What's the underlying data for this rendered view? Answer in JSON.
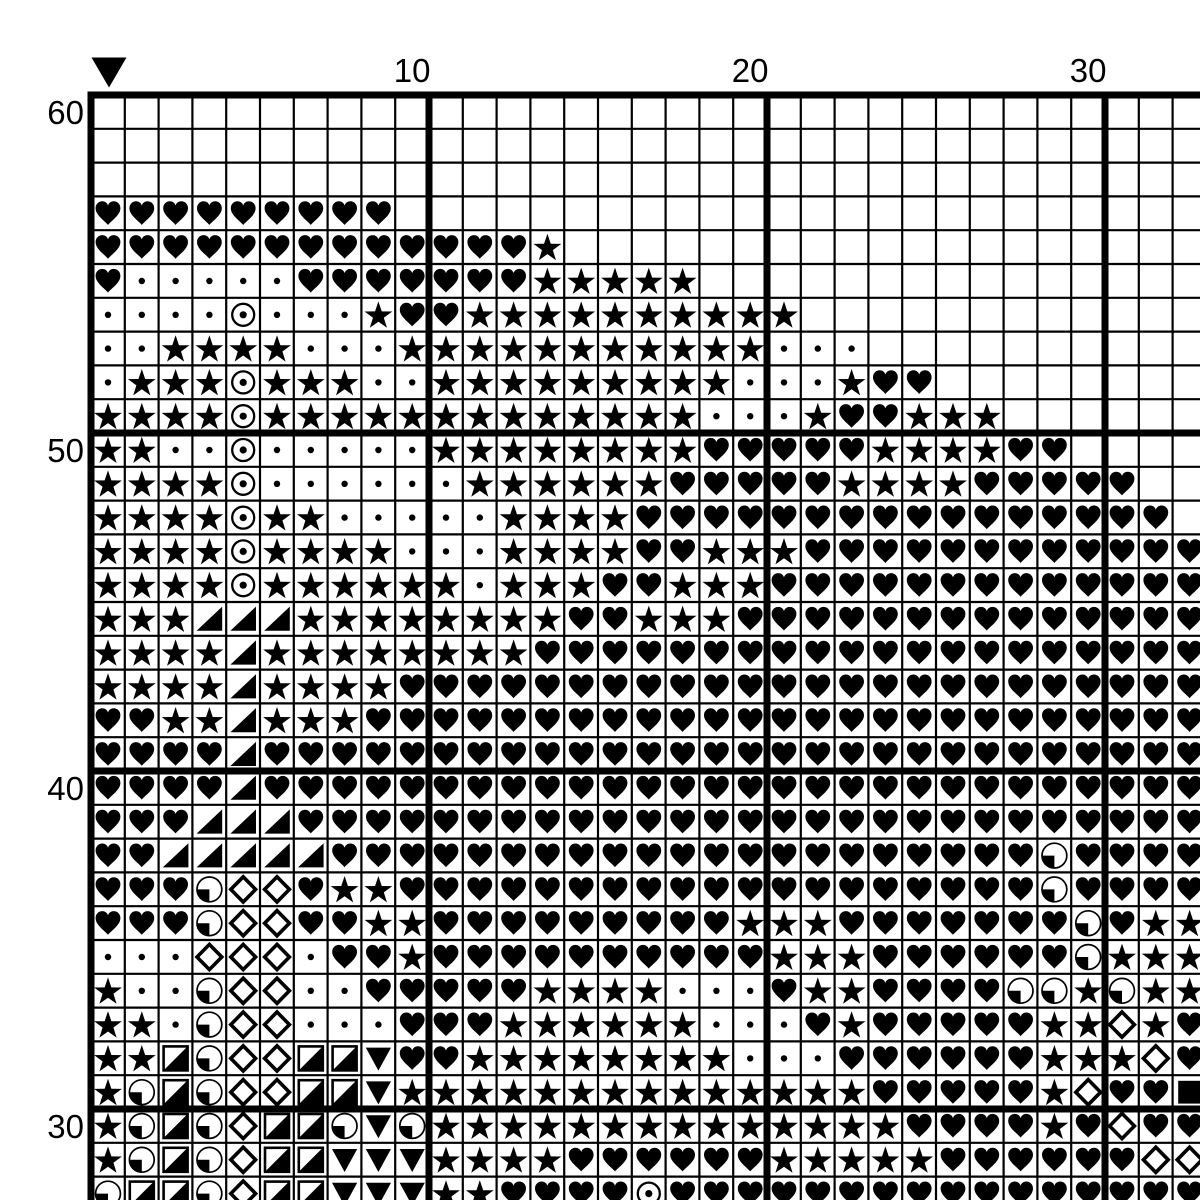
{
  "title": "Cross-stitch pattern chart",
  "colors": {
    "ink": "#000000",
    "background": "#ffffff"
  },
  "legend": {
    "H": "heart",
    "S": "star",
    "d": "dot",
    "O": "circled-dot",
    "T": "shaded-triangle",
    "D": "diamond",
    "Q": "quarter-circle",
    "R": "half-square",
    "V": "down-triangle",
    "B": "solid-square",
    ".": "empty"
  },
  "chart_data": {
    "type": "heatmap",
    "title": "Cross-stitch symbol grid",
    "grid_on": true,
    "cell_rule_every": 10,
    "x_axis": {
      "labels": [
        "10",
        "20",
        "30"
      ],
      "positions": [
        10,
        20,
        30
      ]
    },
    "y_axis": {
      "labels": [
        "60",
        "50",
        "40",
        "30"
      ],
      "positions": [
        60,
        50,
        40,
        30
      ]
    },
    "center_marker": {
      "symbol": "down-triangle",
      "col": 1
    },
    "first_col": 1,
    "first_row": 60,
    "cols_visible": 33,
    "rows": [
      {
        "row": 60,
        "cells": "................................."
      },
      {
        "row": 59,
        "cells": "................................."
      },
      {
        "row": 58,
        "cells": "................................."
      },
      {
        "row": 57,
        "cells": "HHHHHHHHH........................"
      },
      {
        "row": 56,
        "cells": "HHHHHHHHHHHHHS..................."
      },
      {
        "row": 55,
        "cells": "HdddddHHHHHHHSSSSS..............."
      },
      {
        "row": 54,
        "cells": "ddddOdddSHHSSSSSSSSSS............"
      },
      {
        "row": 53,
        "cells": "ddSSSSdddSSSSSSSSSSSddd.........."
      },
      {
        "row": 52,
        "cells": "dSSSOSSSddSSSSSSSSSdddSHH........"
      },
      {
        "row": 51,
        "cells": "SSSSOSSSSSSSSSSSSSdddSHHSSS......"
      },
      {
        "row": 50,
        "cells": "SSddOdddddSSSSSSSSHHHHHSSSSHH...."
      },
      {
        "row": 49,
        "cells": "SSSSOddddddSSSSSSHHHHHSSSSHHHHH.."
      },
      {
        "row": 48,
        "cells": "SSSSOSSdddddSSSSHHHHHHHHHHHHHHHH."
      },
      {
        "row": 47,
        "cells": "SSSSOSSSSdddSSSSHHSSSHHHHHHHHHHHH"
      },
      {
        "row": 46,
        "cells": "SSSSOSSSSSSdSSSHHSSSHHHHHHHHHHHHH"
      },
      {
        "row": 45,
        "cells": "SSSTTTSSSSSSSSHHSSSHHHHHHHHHHHHHH"
      },
      {
        "row": 44,
        "cells": "SSSSTSSSSSSSSHHHHHHHHHHHHHHHHHHHH"
      },
      {
        "row": 43,
        "cells": "SSSSTSSSSHHHHHHHHHHHHHHHHHHHHHHHH"
      },
      {
        "row": 42,
        "cells": "HHSSTSSSHHHHHHHHHHHHHHHHHHHHHHHHH"
      },
      {
        "row": 41,
        "cells": "HHHHTHHHHHHHHHHHHHHHHHHHHHHHHHHHH"
      },
      {
        "row": 40,
        "cells": "HHHHTHHHHHHHHHHHHHHHHHHHHHHHHHHHH"
      },
      {
        "row": 39,
        "cells": "HHHTTTHHHHHHHHHHHHHHHHHHHHHHHHHHH"
      },
      {
        "row": 38,
        "cells": "HHTTTTTHHHHHHHHHHHHHHHHHHHHHQHHHH"
      },
      {
        "row": 37,
        "cells": "HHHQDDHSSHHHHHHHHHHHHHHHHHHHQHHHH"
      },
      {
        "row": 36,
        "cells": "HHHQDDHHSSHHHHHHHHHSSSHHHHHHHQHSS"
      },
      {
        "row": 35,
        "cells": "dddDDDdHHSHHHHHHHHHHSSSHHHHHHQSSS"
      },
      {
        "row": 34,
        "cells": "SddQDDddHHHHHSSSSdddHSSHHHHQQSQSS"
      },
      {
        "row": 33,
        "cells": "SSdQDDdddHHHSSSSSSdddHSHHHHHSSDSH"
      },
      {
        "row": 32,
        "cells": "SSRQDDRRVHHSSSSSSSSdddHHHHHHSSSDH"
      },
      {
        "row": 31,
        "cells": "SQRQDDRRVSSSSSSSSSSSSSSHHHHHSDHHB"
      },
      {
        "row": 30,
        "cells": "SQRQDRRQVQSSSSSSSSSSSSSSHHHHSHDHH"
      },
      {
        "row": 29,
        "cells": "SQRQDRRVVVSSSSHHHHHHSSSSSHHHHHHDD"
      },
      {
        "row": 28,
        "cells": "QRRQDRRVVVSSHHHHOHHHHHHHHHHHHHHHH"
      }
    ]
  }
}
